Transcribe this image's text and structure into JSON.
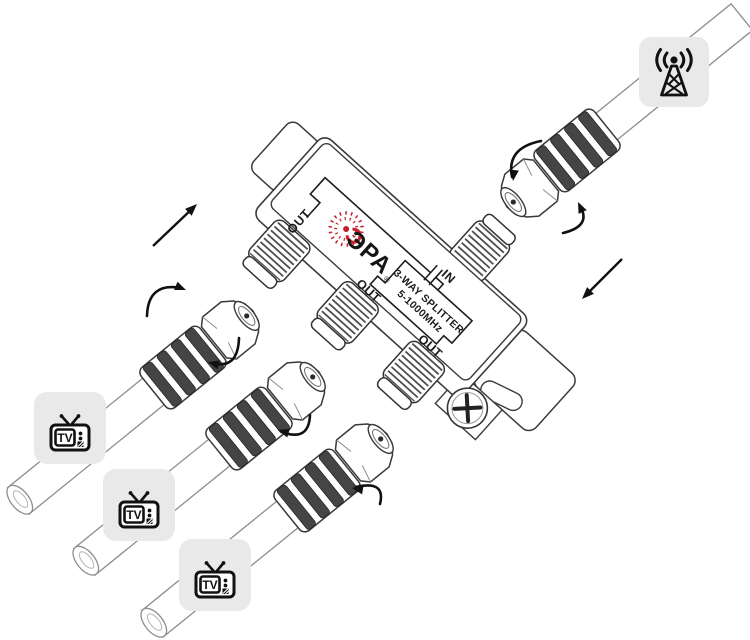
{
  "device": {
    "brand": "ЭРА",
    "registered_mark": "®",
    "splitter_label": "3-WAY SPLITTER",
    "frequency_range": "5-1000MHz",
    "in_label": "IN",
    "out_label": "OUT"
  },
  "icons": {
    "tv_label": "TV",
    "tv_icon": "tv-set-icon",
    "antenna_icon": "radio-tower-icon",
    "rotation_arrow": "curved-rotation-arrow-icon",
    "direction_arrow": "straight-direction-arrow-icon"
  },
  "colors": {
    "background": "#FFFFFF",
    "brand_red": "#C4212A",
    "icon_background": "#E9E9E9",
    "line_black": "#1B1B1B"
  }
}
